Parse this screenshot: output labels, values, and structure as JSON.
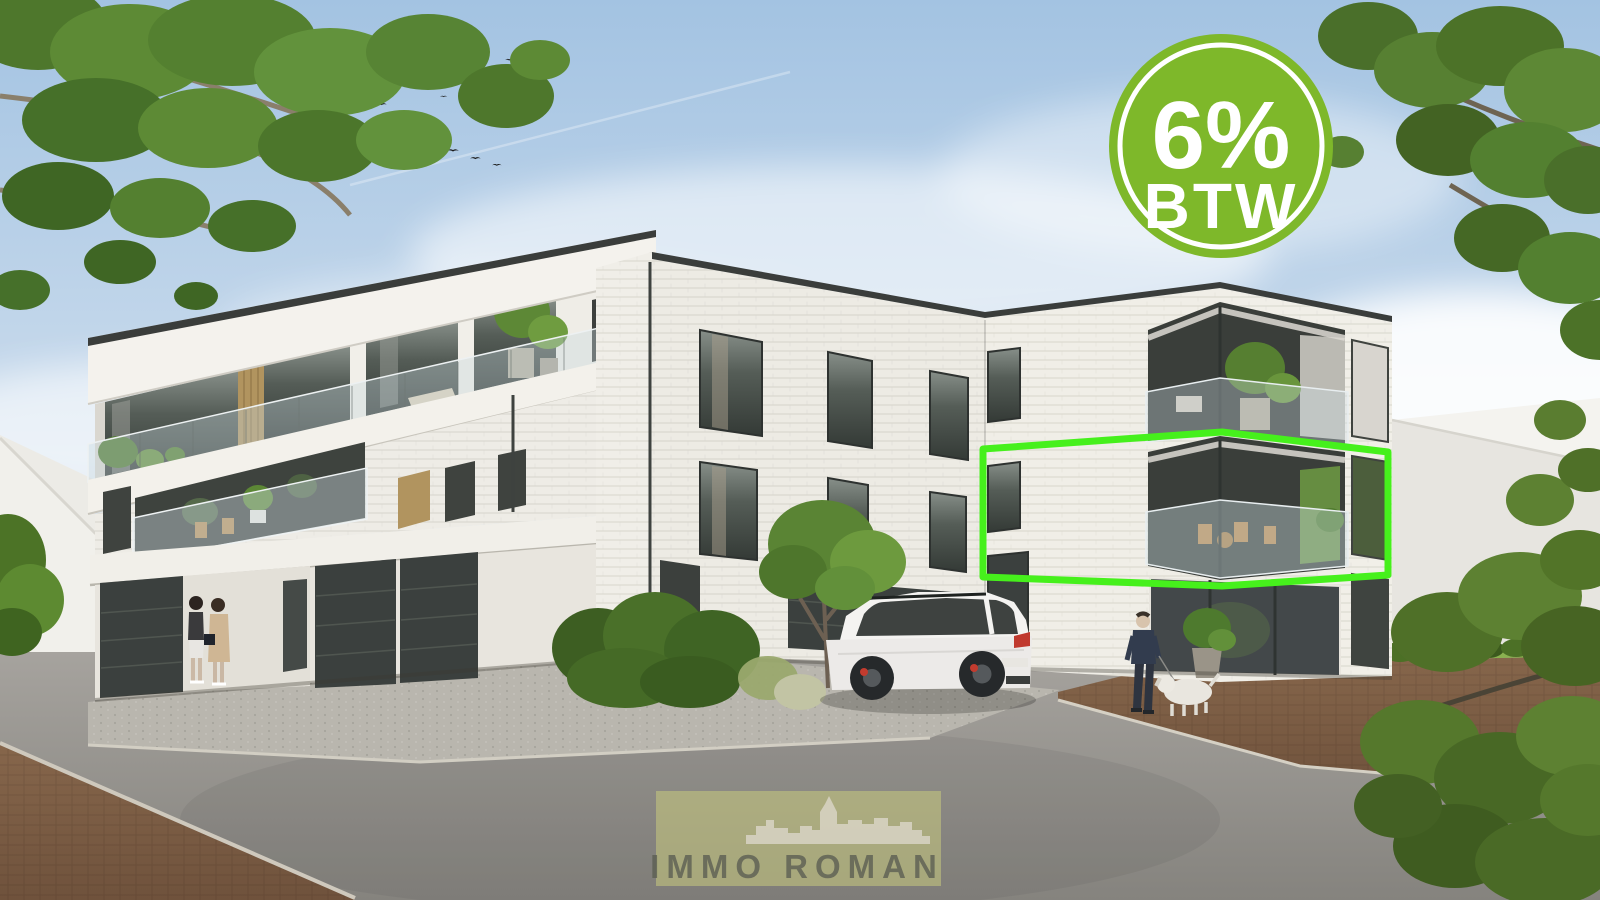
{
  "overlays": {
    "vat_badge": {
      "line1": "6%",
      "line2": "BTW",
      "circle_color": "#7eb82a",
      "ring_color": "#ffffff",
      "text_color": "#ffffff"
    },
    "unit_highlight": {
      "stroke_color": "#46f01c",
      "shape": "perspective-rectangle-around-corner-apartment"
    },
    "watermark": {
      "brand": "IMMO ROMAN",
      "panel_color": "#c8ca7e",
      "text_color": "#5c5f53",
      "skyline_icon": "city-skyline"
    }
  },
  "scene": {
    "colors": {
      "sky_top": "#a3c3e2",
      "wall_white": "#efede7",
      "window_dark": "#3f4340",
      "road_gray": "#9c9a95",
      "paver_brown": "#7e5e45",
      "foliage_green": "#54802f"
    },
    "elements": {
      "building": "white brick apartment residence, three storeys, dark garage doors",
      "vehicle": "white SUV parked at garage",
      "pedestrians_left": "two women at entrance",
      "pedestrian_right": "man walking white dog",
      "birds": "flock of birds in sky"
    }
  }
}
